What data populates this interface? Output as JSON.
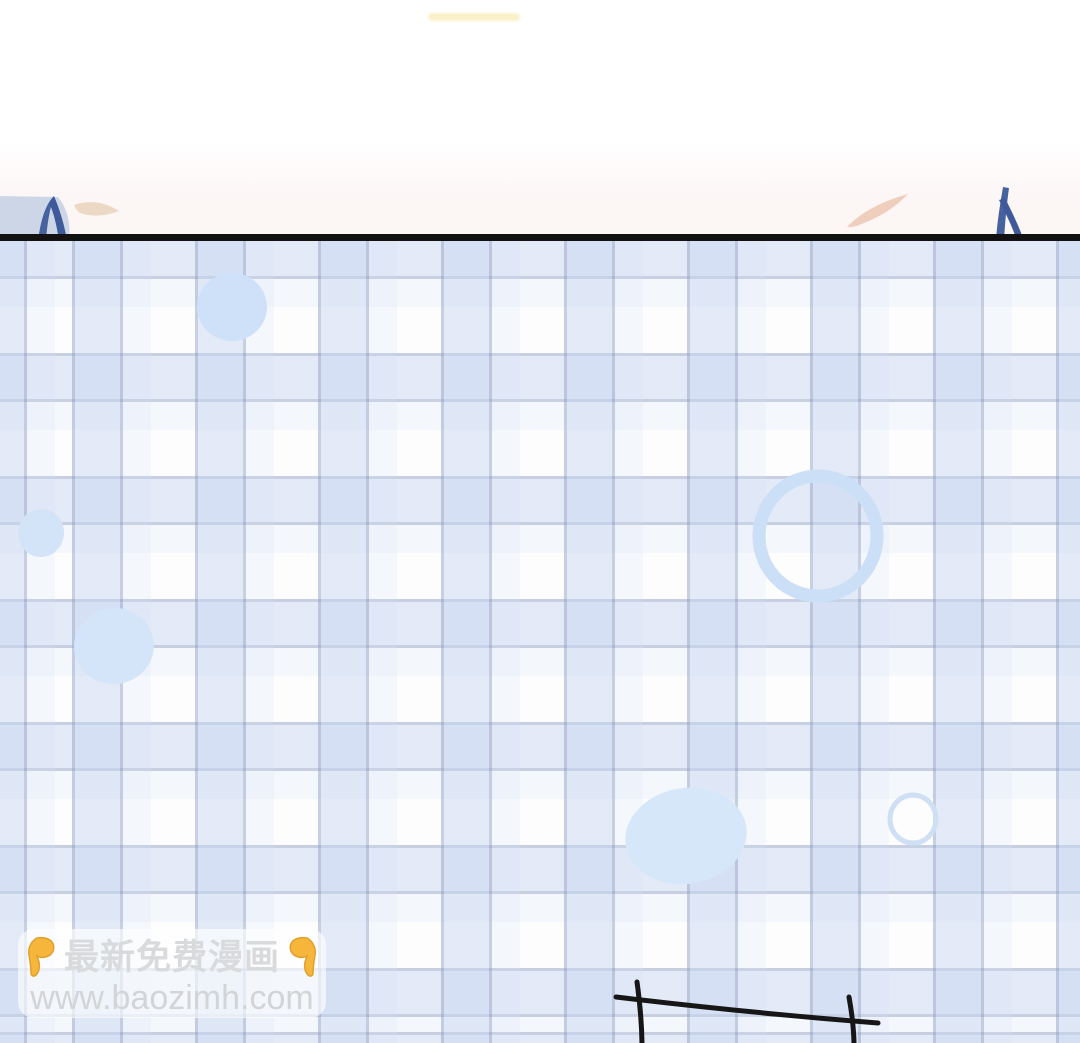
{
  "page": {
    "width": 1080,
    "height": 1043,
    "background": "#ffffff"
  },
  "top_panel": {
    "description": "bottom sliver of previous comic panel",
    "tint_color": "rgba(250,240,238,0.55)",
    "faint_watermark_color": "rgba(247,231,166,0.6)",
    "shoulder_gray": "#cdd6e7",
    "hair_blue": "#46629f",
    "hair_blue_dark": "#3e5a9a",
    "skin_beige": "#ebd8c5",
    "skin_peach": "#f0cebd"
  },
  "separator": {
    "color": "#121212",
    "thickness_px": 7
  },
  "plaid": {
    "background": "#fdfdfe",
    "line_color": "rgba(146,162,196,0.50)",
    "band_color": "rgba(196,212,240,0.45)",
    "shadow_band_color": "rgba(212,224,244,0.20)",
    "period_px": 123,
    "offset_x_px": 72,
    "offset_y_px": -11
  },
  "bubbles": [
    {
      "type": "blob",
      "cx": 232,
      "cy": 307,
      "rx": 35,
      "ry": 34,
      "rotate": 0,
      "fill": "#cfe1f8"
    },
    {
      "type": "blob",
      "cx": 41,
      "cy": 533,
      "rx": 23,
      "ry": 24,
      "rotate": 8,
      "fill": "#d3e4f9"
    },
    {
      "type": "blob",
      "cx": 114,
      "cy": 646,
      "rx": 40,
      "ry": 38,
      "rotate": -6,
      "fill": "#d4e5f9"
    },
    {
      "type": "blob",
      "cx": 686,
      "cy": 836,
      "rx": 61,
      "ry": 48,
      "rotate": -9,
      "fill": "#d7e7fa"
    },
    {
      "type": "ring",
      "cx": 818,
      "cy": 536,
      "rx": 59,
      "ry": 60,
      "rotate": 4,
      "stroke": "#cbdff7",
      "stroke_width": 13
    },
    {
      "type": "ring",
      "cx": 913,
      "cy": 819,
      "rx": 23,
      "ry": 24,
      "rotate": 0,
      "stroke": "#cfe0f5",
      "stroke_width": 5
    }
  ],
  "panel_sketch": {
    "color": "#161616",
    "stroke_width": 5,
    "lines": [
      {
        "x1": 616,
        "y1": 997,
        "x2": 878,
        "y2": 1023,
        "bend": 3
      },
      {
        "x1": 637,
        "y1": 982,
        "x2": 642,
        "y2": 1043,
        "bend": 2
      },
      {
        "x1": 849,
        "y1": 997,
        "x2": 854,
        "y2": 1043,
        "bend": 2
      }
    ]
  },
  "watermark": {
    "line1": "最新免费漫画",
    "line2": "www.baozimh.com",
    "hand_icon": "pointing-down-hand",
    "hand_color": "#f6b63c",
    "hand_outline": "#e0a02b",
    "text_color": "#d9dadc",
    "url_color": "#d3d4d6",
    "box_background": "rgba(255,255,255,0.62)"
  }
}
